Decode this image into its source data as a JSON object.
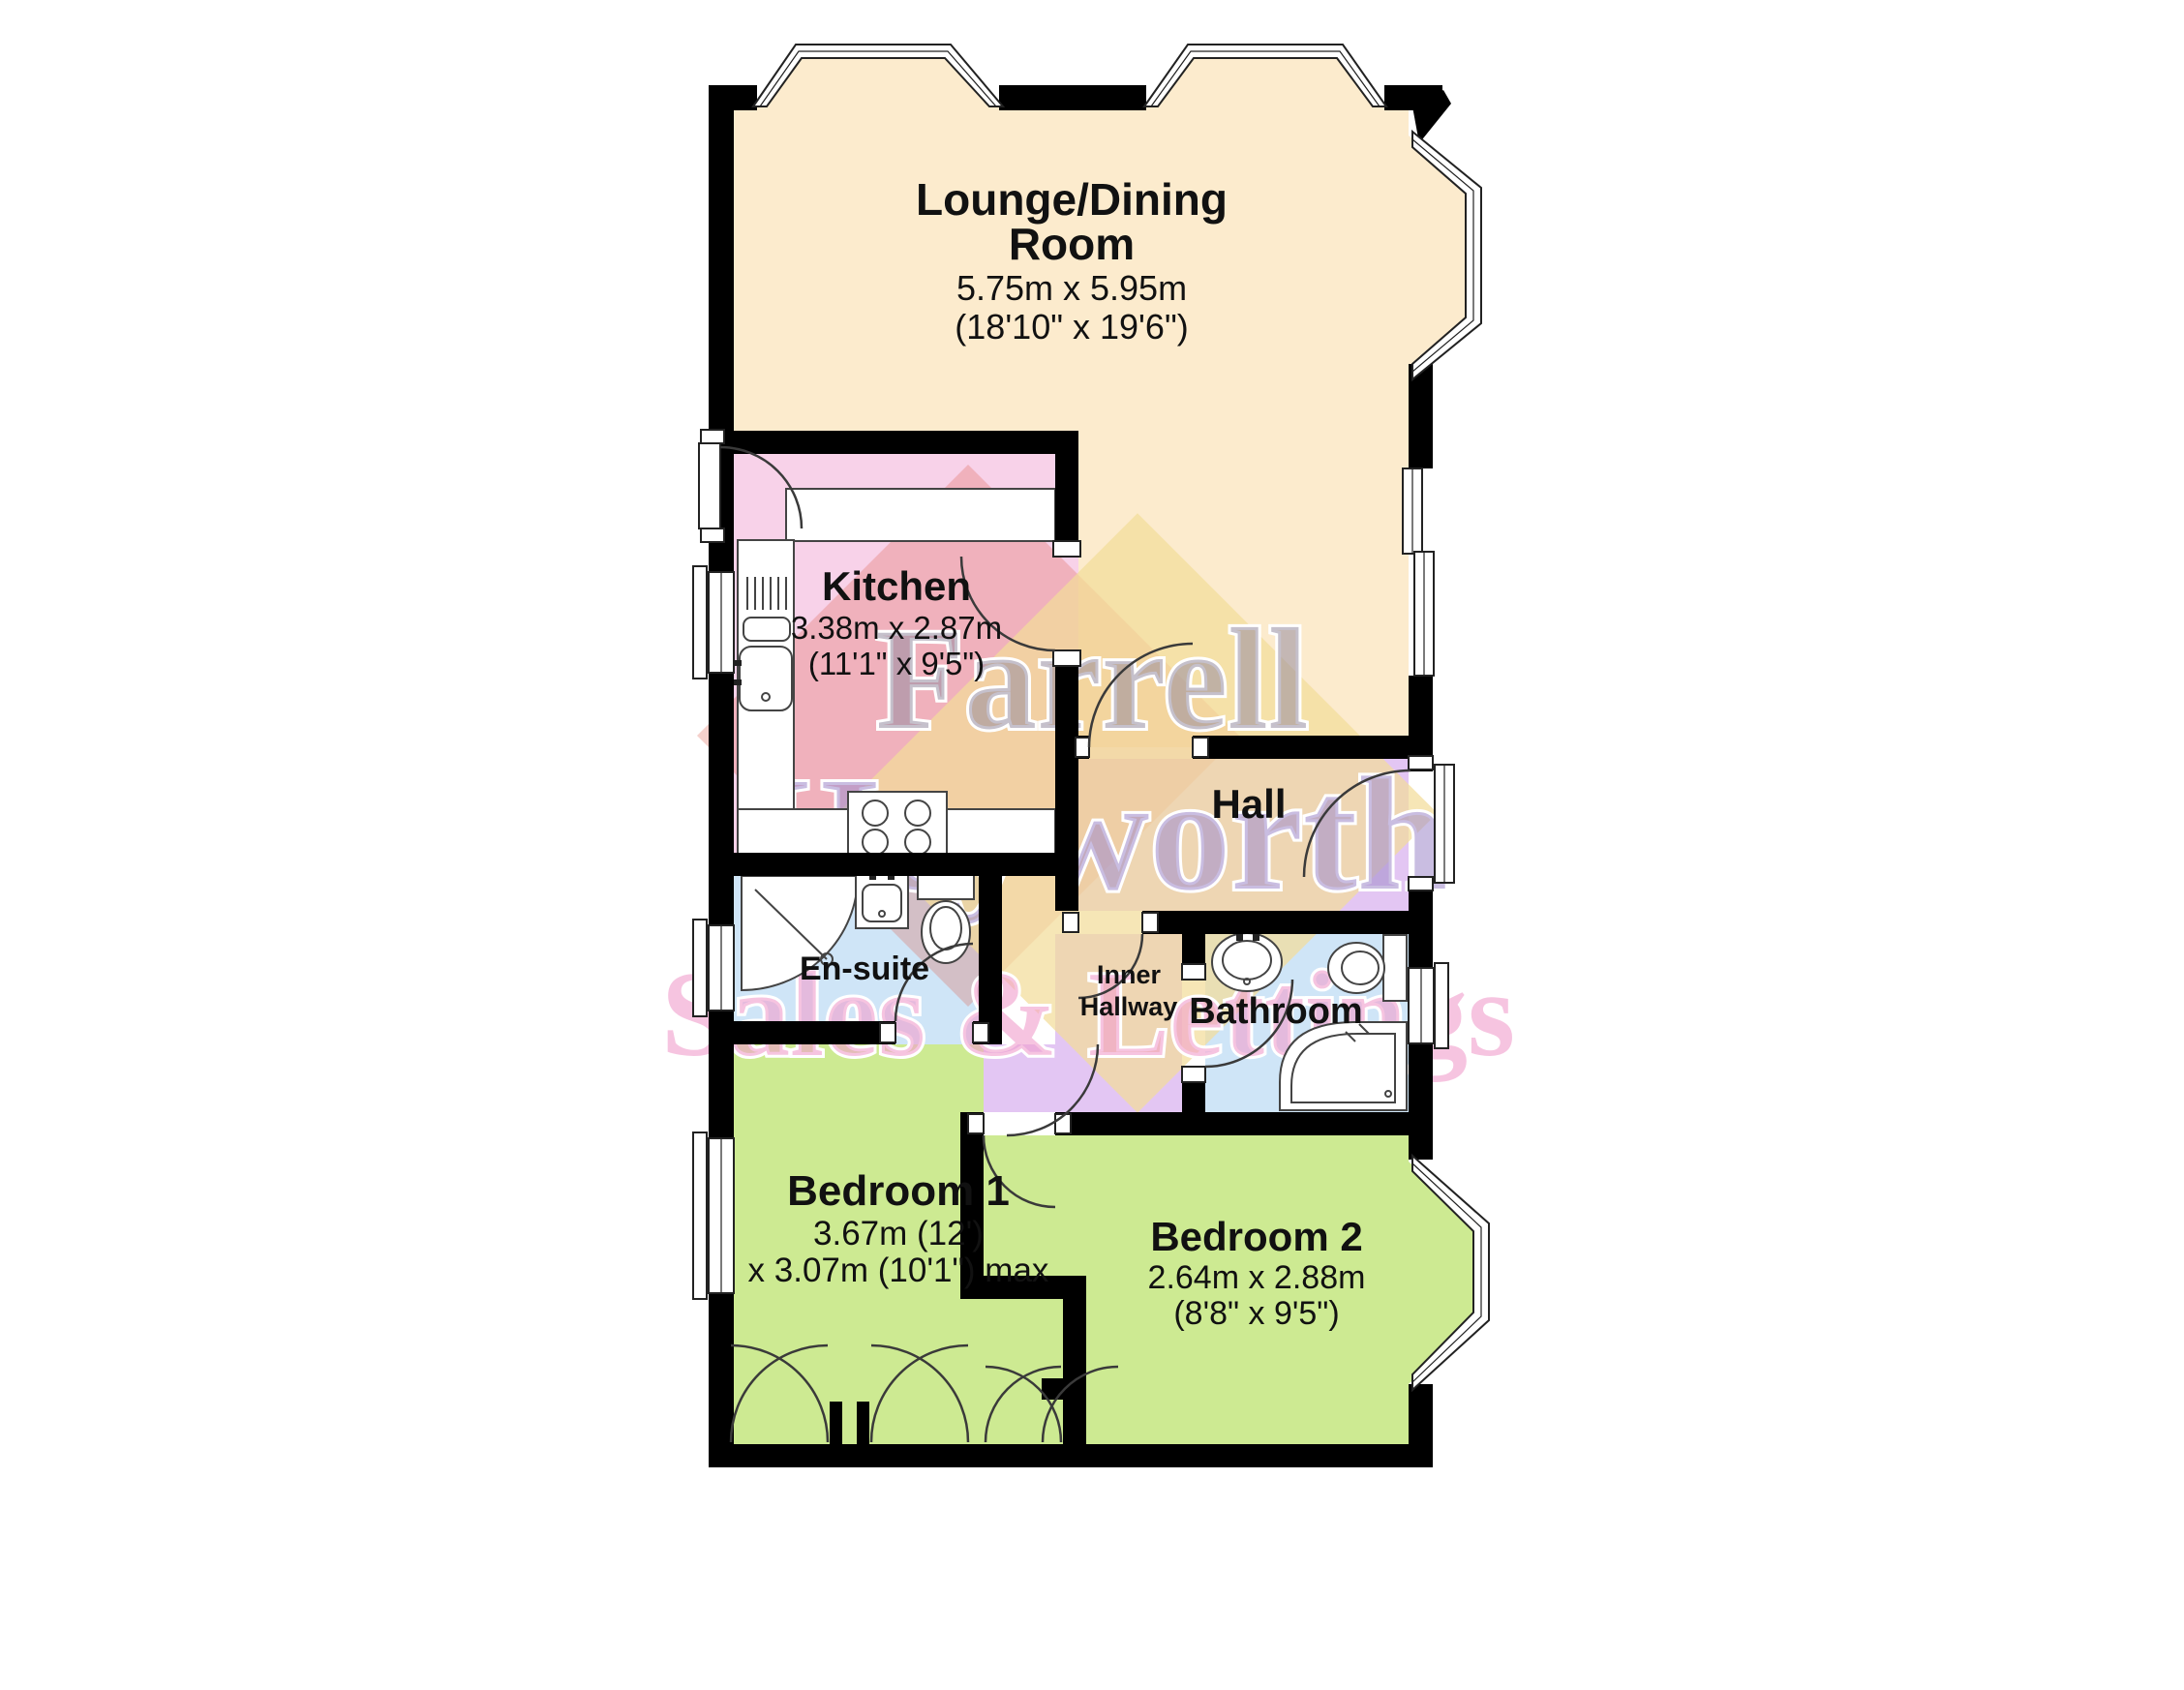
{
  "rooms": {
    "lounge": {
      "name_line1": "Lounge/Dining",
      "name_line2": "Room",
      "dim_metric": "5.75m x 5.95m",
      "dim_imperial": "(18'10\" x 19'6\")"
    },
    "kitchen": {
      "name": "Kitchen",
      "dim_metric": "3.38m x 2.87m",
      "dim_imperial": "(11'1\" x 9'5\")"
    },
    "hall": {
      "name": "Hall"
    },
    "ensuite": {
      "name": "En-suite"
    },
    "inner_hallway": {
      "name_line1": "Inner",
      "name_line2": "Hallway"
    },
    "bathroom": {
      "name": "Bathroom"
    },
    "bedroom1": {
      "name": "Bedroom 1",
      "dim_line1": "3.67m (12')",
      "dim_line2": "x 3.07m (10'1\") max"
    },
    "bedroom2": {
      "name": "Bedroom 2",
      "dim_metric": "2.64m x 2.88m",
      "dim_imperial": "(8'8\" x 9'5\")"
    }
  },
  "watermark": {
    "line1": "Farrell",
    "line2": "Heyworth",
    "line3": "Sales & Lettings"
  },
  "colors": {
    "lounge": "#fcebcd",
    "kitchen": "#f8d2e9",
    "hall": "#e3c6f3",
    "wet_room": "#cfe5f7",
    "bedroom": "#cdea92",
    "cupboard": "#ffffff",
    "walls": "#000000",
    "watermark_yellow": "#f2dd9a",
    "watermark_red": "#dd6655",
    "watermark_gray": "rgba(150,140,160,0.55)",
    "watermark_purple": "rgba(165,145,205,0.60)",
    "watermark_pink": "rgba(240,160,205,0.62)"
  }
}
